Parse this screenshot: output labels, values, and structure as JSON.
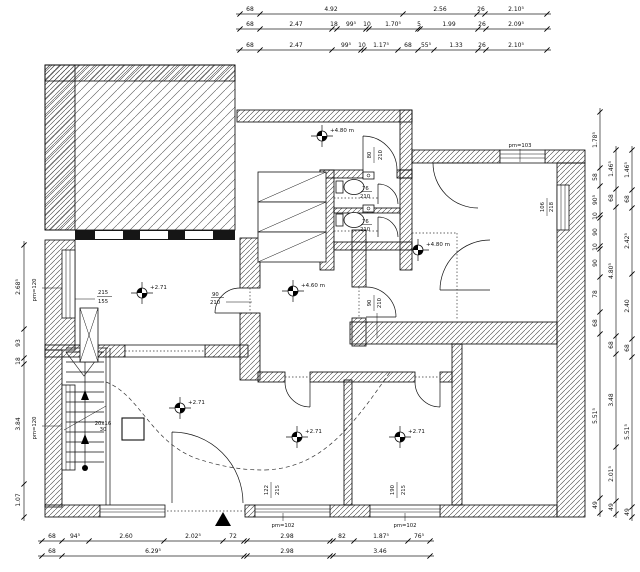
{
  "colors": {
    "line": "#1a1a1a",
    "hatch": "#555"
  },
  "dims": {
    "top_row1": [
      "68",
      "4.92",
      "2.56",
      "26",
      "2.10⁵"
    ],
    "top_row2": [
      "68",
      "2.47",
      "18",
      "99⁵",
      "10",
      "1.70⁵",
      "5",
      "1.99",
      "26",
      "2.09⁵"
    ],
    "top_row3": [
      "68",
      "2.47",
      "99⁵",
      "10",
      "1.17⁵",
      "68",
      "55⁵",
      "1.33",
      "26",
      "2.10⁵"
    ],
    "bottom_row1": [
      "68",
      "94⁵",
      "2.60",
      "2.02⁵",
      "72",
      "2.98",
      "82",
      "1.87⁵",
      "76⁵"
    ],
    "bottom_row2": [
      "68",
      "6.29⁵",
      "2.98",
      "3.46"
    ],
    "left_col": [
      "2.68⁵",
      "93",
      "18",
      "3.84",
      "1.07"
    ],
    "right_inner": [
      "1.78⁵",
      "58",
      "90⁵",
      "10",
      "90",
      "10",
      "90",
      "78",
      "68",
      "5.51⁵",
      "49"
    ],
    "right_middle": [
      "1.46⁵",
      "68",
      "4.80⁵",
      "68",
      "3.48",
      "2.01⁵",
      "49"
    ],
    "right_outer": [
      "1.46⁵",
      "68",
      "2.42⁵",
      "2.40",
      "68",
      "5.51⁵",
      "49"
    ]
  },
  "levels": [
    {
      "label": "+4.80 m"
    },
    {
      "label": "+4.80 m"
    },
    {
      "label": "+4.60 m"
    },
    {
      "label": "+2.71"
    },
    {
      "label": "+2.71"
    },
    {
      "label": "+2.71"
    },
    {
      "label": "+2.71"
    }
  ],
  "labels": {
    "window_215_155": {
      "top": "215",
      "bottom": "155"
    },
    "pm120_upper": "pm=120",
    "pm120_lower": "pm=120",
    "pm103": "pm=103",
    "pm102_left": "pm=102",
    "pm102_right": "pm=102",
    "window_122_215": {
      "top": "122",
      "bottom": "215"
    },
    "window_190_215": {
      "top": "190",
      "bottom": "215"
    },
    "window_106_218": {
      "top": "106",
      "bottom": "218"
    },
    "wc_door_upper": {
      "top": "76",
      "bottom": "210"
    },
    "wc_door_lower": {
      "top": "76",
      "bottom": "210"
    },
    "door_80_210": {
      "top": "80",
      "bottom": "210"
    },
    "door_90_210_left": {
      "top": "90",
      "bottom": "210"
    },
    "door_90_210_mid": {
      "top": "90",
      "bottom": "210"
    },
    "stair_note": {
      "top": "20x16",
      "bottom": "30"
    }
  }
}
